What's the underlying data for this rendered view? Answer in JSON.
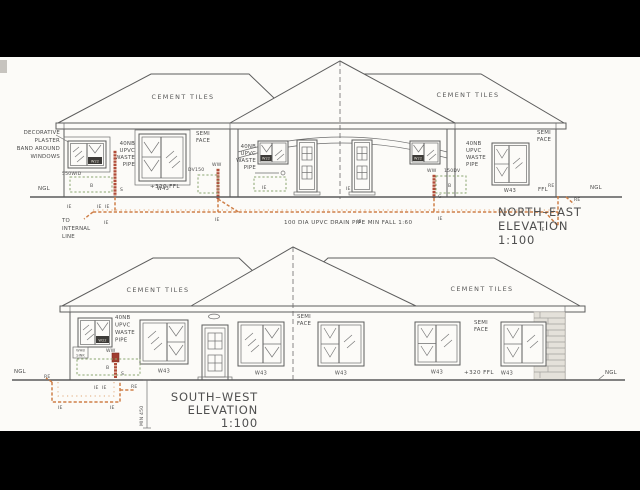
{
  "colors": {
    "background_bar": "#000000",
    "paper": "#fcfbf8",
    "ink": "#5d5d5d",
    "drain_pipe_orange": "#cf8049",
    "waste_pipe_red": "#b14c3a",
    "gulley_green": "#8aa671"
  },
  "common": {
    "cement_tiles": "CEMENT TILES",
    "semi": "SEMI",
    "face": "FACE",
    "waste_pipe_lines": [
      "40NB",
      "UPVC",
      "WASTE",
      "PIPE"
    ],
    "w43": "W43",
    "w22": "W22",
    "ww": "WW",
    "ie": "IE",
    "re": "RE",
    "ngl": "NGL",
    "b": "B",
    "s": "S",
    "g": "G",
    "ffl": "FFL",
    "ffl_320": "+320 FFL"
  },
  "north_east": {
    "title_lines": [
      "NORTH–EAST",
      "ELEVATION",
      "1:100"
    ],
    "decorative_note_lines": [
      "DECORATIVE",
      "PLASTER",
      "BAND AROUND",
      "WINDOWS"
    ],
    "to_internal_lines": [
      "TO",
      "INTERNAL",
      "LINE"
    ],
    "drain_note": "100 DIA UPVC DRAIN PIPE MIN FALL 1:60",
    "wid550": "550WID",
    "dv150": "DV150",
    "dv150b": "150DV"
  },
  "south_west": {
    "title_lines": [
      "SOUTH–WEST",
      "ELEVATION",
      "1:100"
    ],
    "min450": "MIN 450",
    "fixture_lines": [
      "WHB",
      "SINK"
    ]
  }
}
